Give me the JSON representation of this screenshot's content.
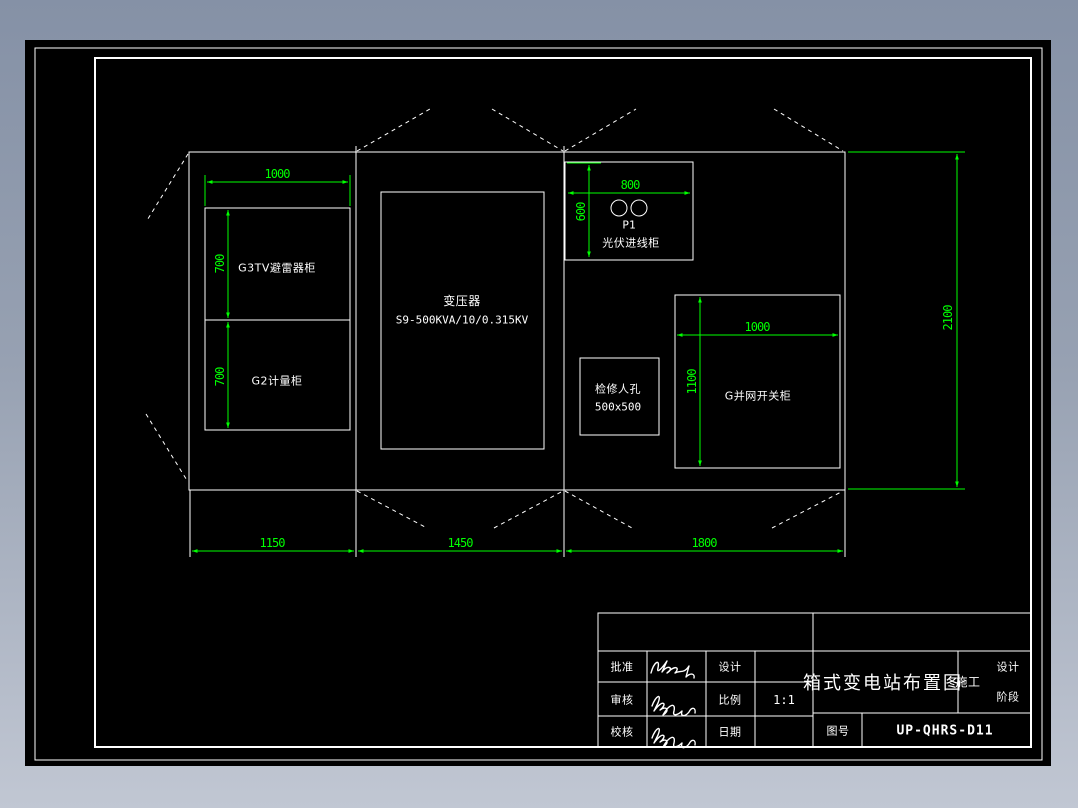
{
  "drawing": {
    "labels": {
      "arrester_cabinet": "G3TV避雷器柜",
      "metering_cabinet": "G2计量柜",
      "transformer_name": "变压器",
      "transformer_spec": "S9-500KVA/10/0.315KV",
      "pv_cabinet_code": "P1",
      "pv_cabinet_name": "光伏进线柜",
      "manhole_name": "检修人孔",
      "manhole_size": "500x500",
      "grid_switch_cabinet": "G并网开关柜"
    },
    "dimensions": {
      "left_cabinet_width": "1000",
      "left_cabinet_cell1_height": "700",
      "left_cabinet_cell2_height": "700",
      "pv_cabinet_width": "800",
      "pv_cabinet_height": "600",
      "switch_cabinet_width": "1000",
      "switch_cabinet_height": "1100",
      "overall_depth": "2100",
      "bay_1_width": "1150",
      "bay_2_width": "1450",
      "bay_3_width": "1800"
    },
    "colors": {
      "dimension_green": "#00ff00",
      "line_white": "#ffffff",
      "canvas_black": "#000000"
    }
  },
  "title_block": {
    "approve_label": "批准",
    "review_label": "审核",
    "proof_label": "校核",
    "design_label": "设计",
    "scale_label": "比例",
    "scale_value": "1:1",
    "date_label": "日期",
    "drawing_title": "箱式变电站布置图",
    "stage_value": "施工",
    "stage_label_line1": "设计",
    "stage_label_line2": "阶段",
    "drawing_no_label": "图号",
    "drawing_no_value": "UP-QHRS-D11"
  }
}
